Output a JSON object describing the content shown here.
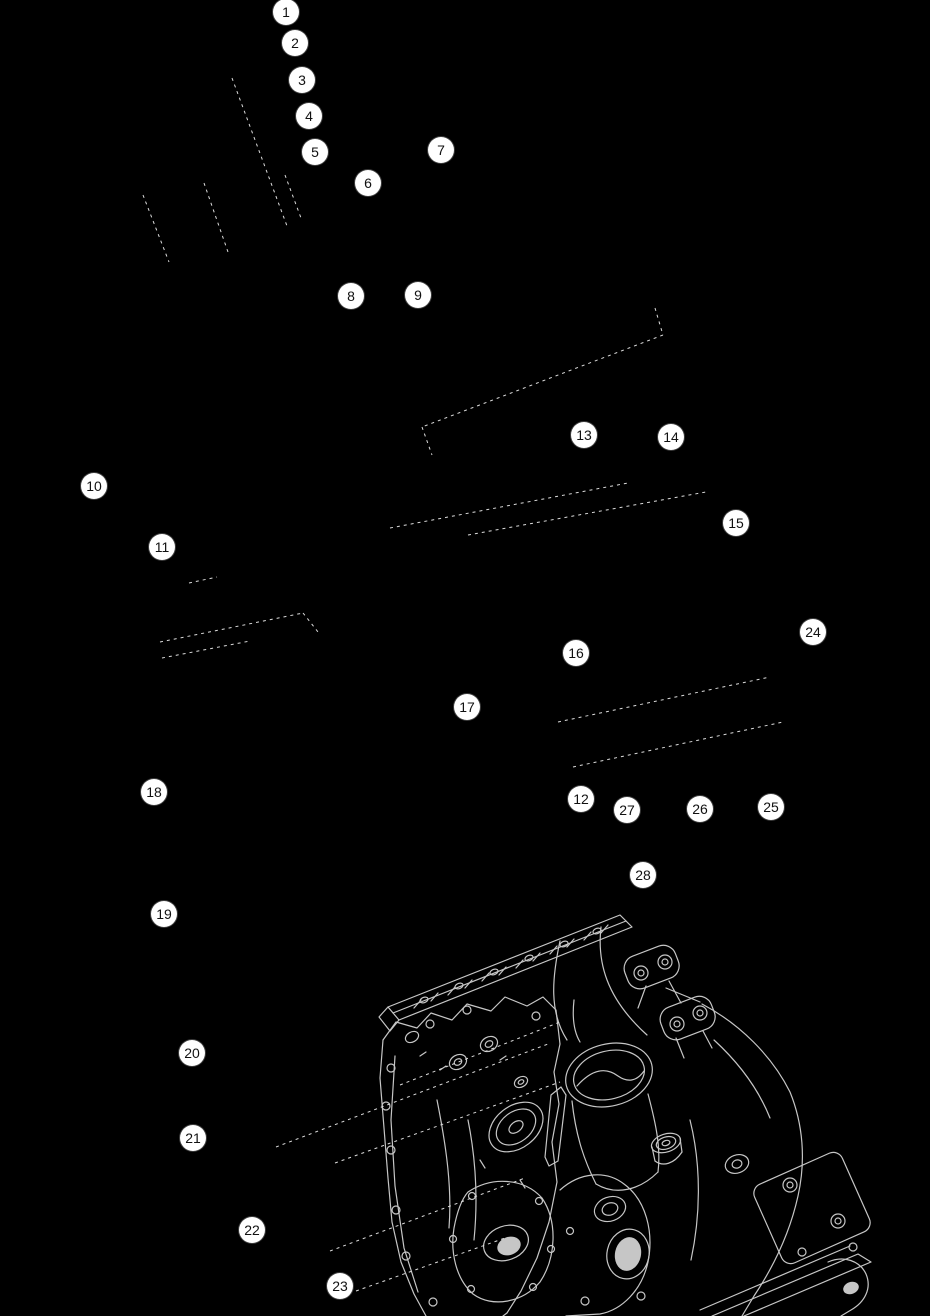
{
  "figure": {
    "type": "exploded-parts-diagram",
    "subject": "engine-crankcase",
    "background_color": "#000000",
    "engine_line_color": "#c6c6c6",
    "leader_line_color": "#dcdcdc",
    "callout": {
      "fill": "#ffffff",
      "text_color": "#111111",
      "diameter": 26
    },
    "callouts": [
      {
        "n": "1",
        "x": 286,
        "y": 12
      },
      {
        "n": "2",
        "x": 295,
        "y": 43
      },
      {
        "n": "3",
        "x": 302,
        "y": 80
      },
      {
        "n": "4",
        "x": 309,
        "y": 116
      },
      {
        "n": "5",
        "x": 315,
        "y": 152
      },
      {
        "n": "6",
        "x": 368,
        "y": 183
      },
      {
        "n": "7",
        "x": 441,
        "y": 150
      },
      {
        "n": "8",
        "x": 351,
        "y": 296
      },
      {
        "n": "9",
        "x": 418,
        "y": 295
      },
      {
        "n": "10",
        "x": 94,
        "y": 486
      },
      {
        "n": "11",
        "x": 162,
        "y": 547
      },
      {
        "n": "12",
        "x": 581,
        "y": 799
      },
      {
        "n": "13",
        "x": 584,
        "y": 435
      },
      {
        "n": "14",
        "x": 671,
        "y": 437
      },
      {
        "n": "15",
        "x": 736,
        "y": 523
      },
      {
        "n": "16",
        "x": 576,
        "y": 653
      },
      {
        "n": "17",
        "x": 467,
        "y": 707
      },
      {
        "n": "18",
        "x": 154,
        "y": 792
      },
      {
        "n": "19",
        "x": 164,
        "y": 914
      },
      {
        "n": "20",
        "x": 192,
        "y": 1053
      },
      {
        "n": "21",
        "x": 193,
        "y": 1138
      },
      {
        "n": "22",
        "x": 252,
        "y": 1230
      },
      {
        "n": "23",
        "x": 340,
        "y": 1286
      },
      {
        "n": "24",
        "x": 813,
        "y": 632
      },
      {
        "n": "25",
        "x": 771,
        "y": 807
      },
      {
        "n": "26",
        "x": 700,
        "y": 809
      },
      {
        "n": "27",
        "x": 627,
        "y": 810
      },
      {
        "n": "28",
        "x": 643,
        "y": 875
      }
    ],
    "part_lines": [
      {
        "x1": 232,
        "y1": 78,
        "x2": 287,
        "y2": 226
      },
      {
        "x1": 285,
        "y1": 175,
        "x2": 301,
        "y2": 218
      },
      {
        "x1": 143,
        "y1": 195,
        "x2": 169,
        "y2": 262
      },
      {
        "x1": 204,
        "y1": 183,
        "x2": 228,
        "y2": 252
      },
      {
        "x1": 655,
        "y1": 308,
        "x2": 663,
        "y2": 335
      },
      {
        "x1": 663,
        "y1": 335,
        "x2": 422,
        "y2": 427
      },
      {
        "x1": 422,
        "y1": 427,
        "x2": 432,
        "y2": 455
      },
      {
        "x1": 390,
        "y1": 528,
        "x2": 628,
        "y2": 483
      },
      {
        "x1": 468,
        "y1": 535,
        "x2": 706,
        "y2": 492
      },
      {
        "x1": 189,
        "y1": 583,
        "x2": 217,
        "y2": 577
      },
      {
        "x1": 160,
        "y1": 642,
        "x2": 303,
        "y2": 613
      },
      {
        "x1": 303,
        "y1": 613,
        "x2": 318,
        "y2": 632
      },
      {
        "x1": 162,
        "y1": 658,
        "x2": 250,
        "y2": 641
      },
      {
        "x1": 558,
        "y1": 722,
        "x2": 770,
        "y2": 677
      },
      {
        "x1": 573,
        "y1": 767,
        "x2": 783,
        "y2": 722
      },
      {
        "x1": 400,
        "y1": 1085,
        "x2": 560,
        "y2": 1022
      },
      {
        "x1": 276,
        "y1": 1147,
        "x2": 548,
        "y2": 1044
      },
      {
        "x1": 335,
        "y1": 1163,
        "x2": 560,
        "y2": 1082
      },
      {
        "x1": 330,
        "y1": 1251,
        "x2": 525,
        "y2": 1178
      },
      {
        "x1": 356,
        "y1": 1291,
        "x2": 505,
        "y2": 1238
      }
    ]
  }
}
